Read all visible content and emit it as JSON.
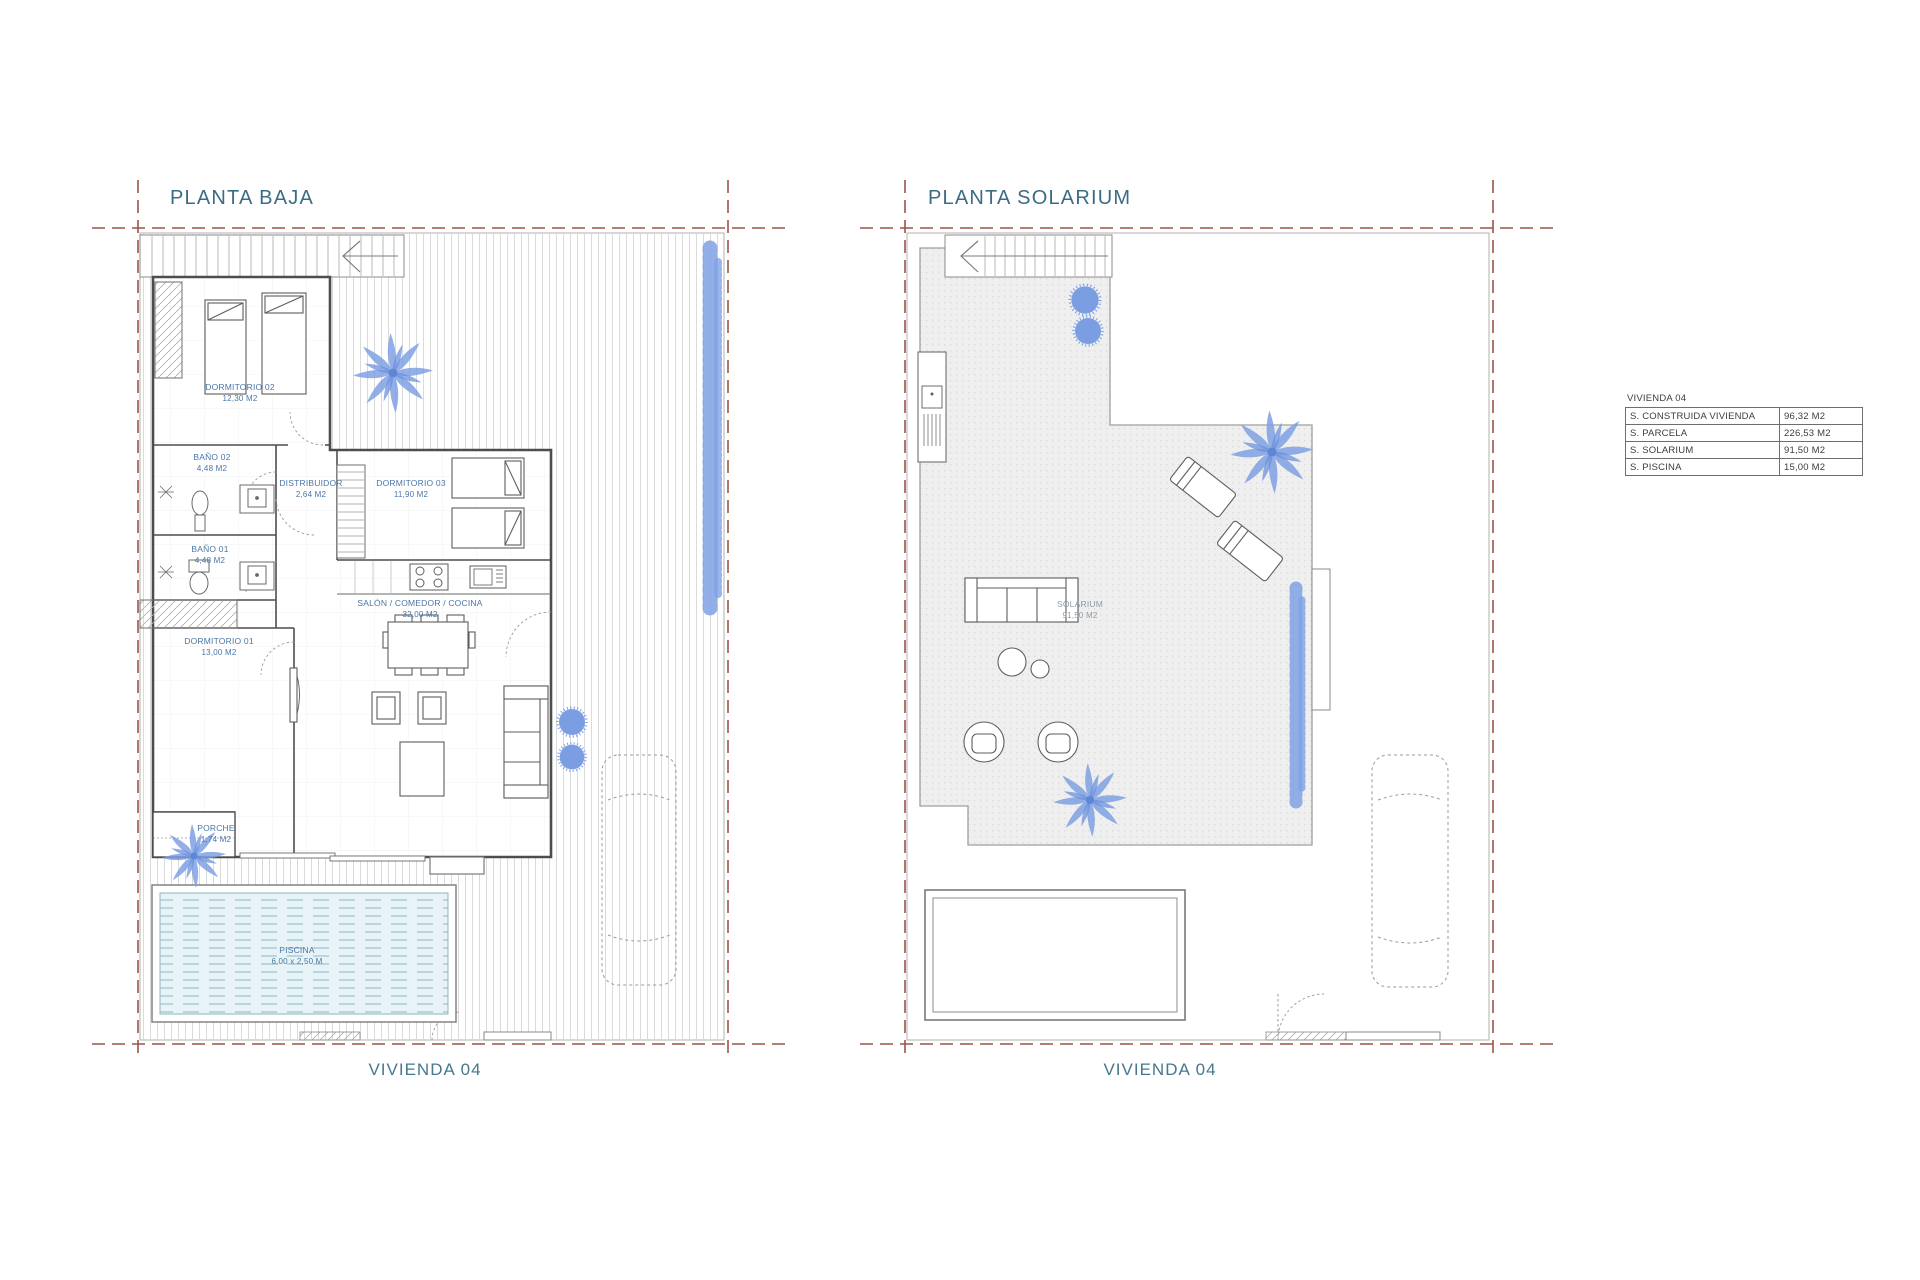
{
  "document": {
    "type": "architectural-floor-plans",
    "unit_label": "M2"
  },
  "colors": {
    "title_blue": "#3c6c84",
    "footer_blue": "#45798f",
    "label_blue": "#4a76a8",
    "solarium_label_gray": "#8d9aa6",
    "setback_dash_red": "#9c5349",
    "wall_dark": "#4d4d4d",
    "hatch_gray": "#d9d9d9",
    "slab_gray": "#efefef",
    "pool_fill": "#e7f3f6",
    "pool_line": "#8ab8c0",
    "vegetation_blue": "#7b9ee3"
  },
  "plans": {
    "left": {
      "title": "PLANTA BAJA",
      "footer": "VIVIENDA 04",
      "rooms": [
        {
          "name": "DORMITORIO 02",
          "area": "12,30 M2"
        },
        {
          "name": "BAÑO 02",
          "area": "4,48 M2"
        },
        {
          "name": "DISTRIBUIDOR",
          "area": "2,64 M2"
        },
        {
          "name": "DORMITORIO 03",
          "area": "11,90 M2"
        },
        {
          "name": "BAÑO 01",
          "area": "4,48 M2"
        },
        {
          "name": "SALÓN / COMEDOR / COCINA",
          "area": "32,00 M2"
        },
        {
          "name": "DORMITORIO 01",
          "area": "13,00 M2"
        },
        {
          "name": "PORCHE",
          "area": "1,74 M2"
        },
        {
          "name": "PISCINA",
          "area": "6,00 x 2,50 M"
        }
      ]
    },
    "right": {
      "title": "PLANTA SOLARIUM",
      "footer": "VIVIENDA 04",
      "rooms": [
        {
          "name": "SOLARIUM",
          "area": "91,50 M2"
        }
      ]
    }
  },
  "summary_table": {
    "title": "VIVIENDA 04",
    "rows": [
      {
        "label": "S. CONSTRUIDA VIVIENDA",
        "value": "96,32 M2"
      },
      {
        "label": "S. PARCELA",
        "value": "226,53 M2"
      },
      {
        "label": "S. SOLARIUM",
        "value": "91,50 M2"
      },
      {
        "label": "S. PISCINA",
        "value": "15,00 M2"
      }
    ]
  }
}
